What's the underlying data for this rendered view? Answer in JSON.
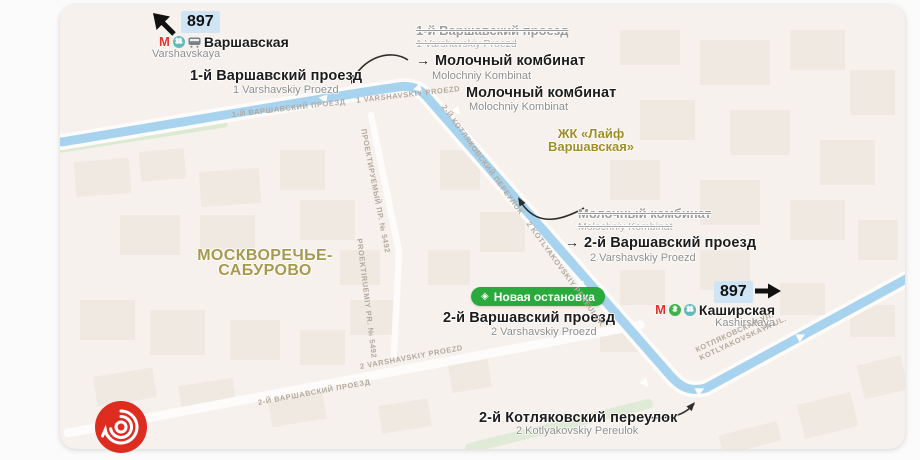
{
  "route": {
    "number": "897"
  },
  "colors": {
    "route_blue": "#a8d3ef",
    "badge_blue": "#cfe4f4",
    "new_stop_green": "#2aa93c",
    "metro_red": "#e0322b",
    "line2_green": "#3cb44a",
    "line11_teal": "#62b9bc",
    "district_olive": "#a6994d",
    "zhk_gold": "#a28d29",
    "logo_red": "#de2c21"
  },
  "terminals": {
    "varshavskaya": {
      "metro_logo": "М",
      "line_badges": [
        "11"
      ],
      "name_ru": "Варшавская",
      "name_en": "Varshavskaya"
    },
    "kashirskaya": {
      "metro_logo": "М",
      "line_badges": [
        "2",
        "11"
      ],
      "name_ru": "Каширская",
      "name_en": "Kashirskaya"
    }
  },
  "stops": {
    "varshavsky1": {
      "ru": "1-й Варшавский проезд",
      "en": "1 Varshavskiy Proezd"
    },
    "renamed_1": {
      "old_ru": "1-й Варшавский проезд",
      "old_en": "1 Varshavskiy Proezd",
      "arrow": "→",
      "new_ru": "Молочный комбинат",
      "new_en": "Molochniy Kombinat"
    },
    "molochny": {
      "ru": "Молочный комбинат",
      "en": "Molochniy Kombinat"
    },
    "renamed_2": {
      "old_ru": "Молочный комбинат",
      "old_en": "Molochniy Kombinat",
      "arrow": "→",
      "new_ru": "2-й Варшавский проезд",
      "new_en": "2 Varshavskiy Proezd"
    },
    "varshavsky2": {
      "ru": "2-й Варшавский проезд",
      "en": "2 Varshavskiy Proezd"
    },
    "kotlyakovsky": {
      "ru": "2-й Котляковский переулок",
      "en": "2 Kotlyakovskiy Pereulok"
    }
  },
  "badge_new_stop": {
    "icon": "◈",
    "label": "Новая остановка"
  },
  "places": {
    "district_line1": "МОСКВОРЕЧЬЕ-",
    "district_line2": "САБУРОВО",
    "zhk_line1": "ЖК «Лайф",
    "zhk_line2": "Варшавская»"
  },
  "roads": {
    "varshavsky1": "1-Й ВАРШАВСКИЙ ПРОЕЗД    1 VARSHAVSKIY PROEZD",
    "kotlyakovsky2": "2-Й КОТЛЯКОВСКИЙ ПЕРЕУЛОК    2 KOTLYAKOVSKIY PEREULOK",
    "proektiruemy_ru": "ПРОЕКТИРУЕМЫЙ ПР. № 5492",
    "proektiruemy_en": "PROEKTIRUEMIY PR. № 5492",
    "varshavsky2_ru": "2-Й ВАРШАВСКИЙ ПРОЕЗД",
    "varshavsky2_en": "2 VARSHAVSKIY PROEZD",
    "kotlyakovskaya_ru": "КОТЛЯКОВСКАЯ УЛ.",
    "kotlyakovskaya_en": "KOTLYAKOVSKAYA UL."
  }
}
